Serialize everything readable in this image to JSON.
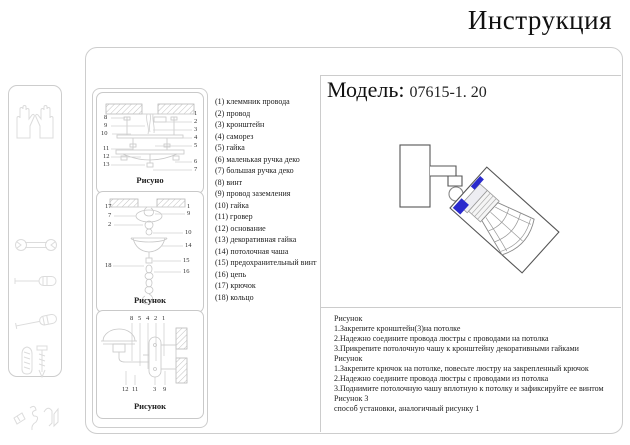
{
  "title": "Инструкция",
  "model": {
    "label": "Модель:",
    "number": "07615-1. 20"
  },
  "parts_list": [
    "(1) клеммник провода",
    "(2) провод",
    "(3) кронштейн",
    "(4) саморез",
    "(5) гайка",
    "(6) маленькая ручка деко",
    "(7) большая ручка деко",
    "(8) винт",
    "(9) провод заземления",
    "(10) гайка",
    "(11) гровер",
    "(12) основание",
    "(13) декоративная гайка",
    "(14) потолочная чаша",
    "(15) предохранительный винт",
    "(16) цепь",
    "(17) крючок",
    "(18) кольцо"
  ],
  "figures": [
    {
      "label": "Рисуно",
      "left_nums": [
        "8",
        "9",
        "10",
        "11",
        "12",
        "13"
      ],
      "right_nums": [
        "1",
        "2",
        "3",
        "4",
        "5",
        "6",
        "7"
      ]
    },
    {
      "label": "Рисунок",
      "left_nums": [
        "17",
        "7",
        "2",
        "18"
      ],
      "right_nums": [
        "1",
        "9",
        "10",
        "14",
        "15",
        "16"
      ]
    },
    {
      "label": "Рисунок",
      "top_nums": [
        "8",
        "5",
        "4",
        "2",
        "1"
      ],
      "bottom_nums": [
        "12",
        "11",
        "3",
        "9"
      ]
    }
  ],
  "instructions": [
    "Рисунок",
    "1.Закрепите кронштейн(3)на потолке",
    "2.Надежно соедините провода люстры с проводами на потолка",
    "3.Прикрепите потолочную чашу к кронштейну декоративными гайками",
    "Рисунок",
    "1.Закрепите крючок на потолке, повесьте люстру на закрепленный крючок",
    "2.Надежно соедините провода люстры с проводами из потолка",
    "3.Поднимите потолочную чашу вплотную к потолку и зафиксируйте ее винтом",
    "Рисунок 3",
    "способ установки,  аналогичный рисунку 1"
  ],
  "colors": {
    "accent_blue": "#2a2acd",
    "line_light": "#c7c7c7",
    "border": "#cccccc"
  }
}
